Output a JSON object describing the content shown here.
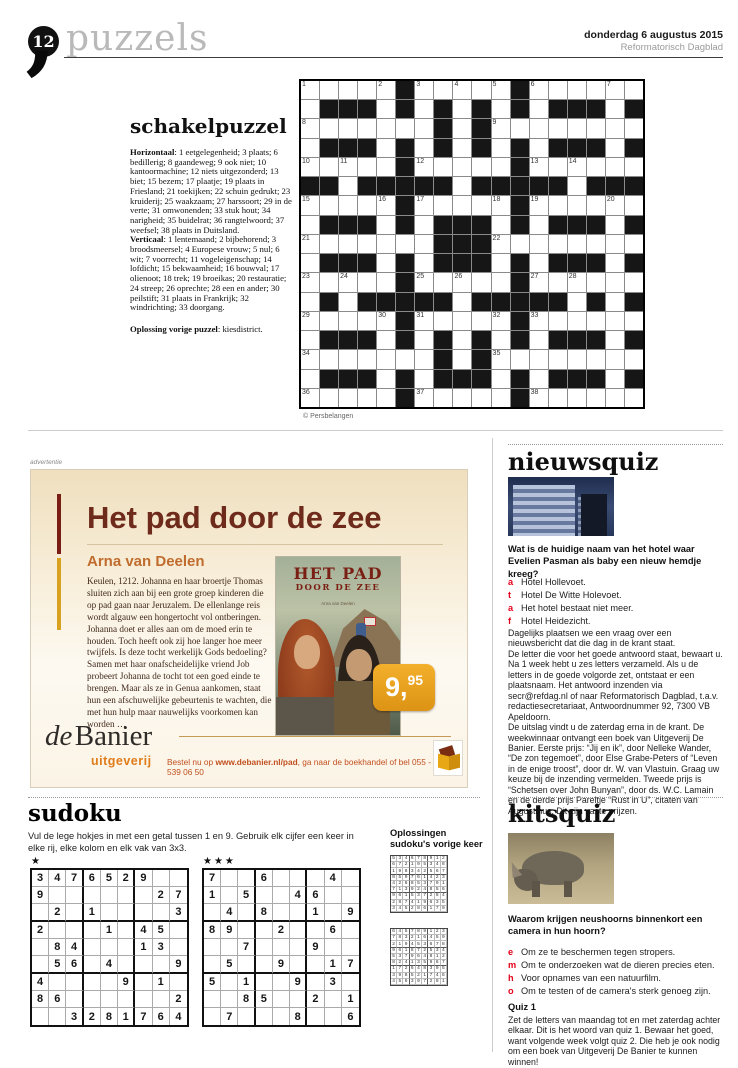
{
  "header": {
    "page_number": "12",
    "section_title": "puzzels",
    "date": "donderdag 6 augustus 2015",
    "publication": "Reformatorisch Dagblad"
  },
  "schakelpuzzel": {
    "title": "schakelpuzzel",
    "horizontaal_label": "Horizontaal",
    "horizontaal": " 1 eetgelegenheid; 3 plaats; 6 bedillerig; 8 gaandeweg; 9 ook niet; 10 kantoormachine; 12 niets uitgezonderd; 13 biet; 15 bezem; 17 plaatje; 19 plaats in Friesland; 21 toekijken; 22 schuin gedrukt; 23 kruiderij; 25 waakzaam; 27 harssoort; 29 in de verte; 31 omwonenden; 33 stuk hout; 34 narigheid; 35 buidelrat; 36 rangtelwoord; 37 weefsel; 38 plaats in Duitsland.",
    "verticaal_label": "Verticaal",
    "verticaal": " 1 lentemaand; 2 bijbehorend; 3 broodsmeersel; 4 Europese vrouw; 5 nul; 6 wit; 7 voorrecht; 11 vogeleigenschap; 14 lofdicht; 15 bekwaamheid; 16 bouwval; 17 olienoot; 18 trek; 19 broeikas; 20 restauratie; 24 streep; 26 oprechte; 28 een en ander; 30 peilstift; 31 plaats in Frankrijk; 32 windrichting; 33 doorgang.",
    "oplossing_label": "Oplossing vorige puzzel",
    "oplossing_text": " kiesdistrict.",
    "credit": "© Persbelangen",
    "grid": {
      "cols": 18,
      "rows": [
        ".....#.....#......",
        ".###.#.#.#.#.###.#",
        ".......#.#........",
        ".###.#.#.#.#.###.#",
        ".....#.....#......",
        "##.#####.#####.###",
        ".....#.....#......",
        ".###.#.###.#.###.#",
        ".......###........",
        ".###.#.###.#.###.#",
        ".....#.....#......",
        ".#.#####.#####.#.#",
        ".....#.....#......",
        ".###.#.#.#.#.###.#",
        ".......#.#........",
        ".###.#.###.#.###.#",
        ".....#.....#......"
      ],
      "numbers": {
        "1-1": "1",
        "1-5": "2",
        "1-7": "3",
        "1-9": "4",
        "1-11": "5",
        "1-13": "6",
        "1-17": "7",
        "3-1": "8",
        "3-11": "9",
        "5-1": "10",
        "5-3": "11",
        "5-7": "12",
        "5-13": "13",
        "5-15": "14",
        "7-1": "15",
        "7-5": "16",
        "7-7": "17",
        "7-11": "18",
        "7-13": "19",
        "7-17": "20",
        "9-1": "21",
        "9-11": "22",
        "11-1": "23",
        "11-3": "24",
        "11-7": "25",
        "11-9": "26",
        "11-13": "27",
        "11-15": "28",
        "13-1": "29",
        "13-5": "30",
        "13-7": "31",
        "13-11": "32",
        "13-13": "33",
        "15-1": "34",
        "15-11": "35",
        "17-1": "36",
        "17-7": "37",
        "17-13": "38"
      }
    }
  },
  "ad": {
    "marker": "advertentie",
    "title": "Het pad door de zee",
    "author": "Arna van Deelen",
    "body": "Keulen, 1212. Johanna en haar broertje Thomas sluiten zich aan bij een grote groep kinderen die op pad gaan naar Jeruzalem. De ellenlange reis wordt algauw een hongertocht vol ontberingen. Johanna doet er alles aan om de moed erin te houden. Toch heeft ook zij hoe langer hoe meer twijfels. Is deze tocht werkelijk Gods bedoeling? Samen met haar onafscheidelijke vriend Job probeert Johanna de tocht tot een goed einde te brengen. Maar als ze in Genua aankomen, staat hun een afschuwelijke gebeurtenis te wachten, die met hun hulp maar nauwelijks voorkomen kan worden …",
    "cover_title": "HET PAD",
    "cover_subtitle": "DOOR DE ZEE",
    "cover_author": "Arna van Deelen",
    "price_main": "9,",
    "price_sup": "95",
    "publisher_de": "de",
    "publisher_name": "Banier",
    "publisher_sub": "uitgeverij",
    "order_prefix": "Bestel nu op ",
    "order_url": "www.debanier.nl/pad",
    "order_suffix": ", ga naar de boekhandel of bel 055 - 539 06 50"
  },
  "nieuwsquiz": {
    "title": "nieuwsquiz",
    "question": "Wat is de huidige naam van het hotel waar Evelien Pasman als baby een nieuw hemdje kreeg?",
    "options": [
      {
        "letter": "a",
        "text": "Hotel Hollevoet."
      },
      {
        "letter": "t",
        "text": "Hotel De Witte Holevoet."
      },
      {
        "letter": "a",
        "text": "Het hotel bestaat niet meer."
      },
      {
        "letter": "f",
        "text": "Hotel Heidezicht."
      }
    ],
    "body1": "Dagelijks plaatsen we een vraag over een nieuwsbericht dat die dag in de krant staat.",
    "body2": "De letter die voor het goede antwoord staat, bewaart u. Na 1 week hebt u zes letters verzameld. Als u de letters in de goede volgorde zet, ontstaat er een plaatsnaam. Het antwoord inzenden via secr@refdag.nl of naar Reformatorisch Dagblad, t.a.v. redactiesecretariaat, Antwoordnummer 92, 7300 VB Apeldoorn.",
    "body3": "De uitslag vindt u de zaterdag erna in de krant. De weekwinnaar ontvangt een boek van Uitgeverij De Banier. Eerste prijs: “Jij en ik”, door Nelleke Wander, “De zon tegemoet”, door Else Grabe-Peters of “Leven in de enige troost”, door dr. W. van Vlastuin. Graag uw keuze bij de inzending vermelden. Tweede prijs is “Schetsen over John Bunyan”, door ds. W.C. Lamain en de derde prijs Pareltje “Rust in U”, citaten van Augustinus. Dit zijn vaste prijzen."
  },
  "sudoku": {
    "title": "sudoku",
    "intro": "Vul de lege hokjes in met een getal tussen 1 en 9. Gebruik elk cijfer een keer in elke rij, elke kolom en elk vak van 3x3.",
    "grid1_stars": "★",
    "grid2_stars": "★★★",
    "grid1": [
      "3476529..",
      "9......27",
      ".2.1....3",
      "2...1.45.",
      ".84...13.",
      ".56.4...9",
      "4....9.1.",
      "86......2",
      "..3281764"
    ],
    "grid2": [
      "7..6...4.",
      "1.5..46..",
      ".4.8..1.9",
      "89..2..6.",
      "..7...9..",
      ".5..9..17",
      "5.1..9.3.",
      "..85..2.1",
      ".7...8..6"
    ],
    "solutions_label_line1": "Oplossingen",
    "solutions_label_line2": "sudoku's vorige keer",
    "solution1": [
      "534678912",
      "672195348",
      "198342567",
      "859761423",
      "426853791",
      "713924856",
      "961537284",
      "287419635",
      "345286179"
    ],
    "solution2": [
      "645789123",
      "783216459",
      "219453678",
      "961872534",
      "537964812",
      "824135967",
      "172648395",
      "398521746",
      "456397281"
    ]
  },
  "kitsquiz": {
    "title": "kitsquiz",
    "question": "Waarom krijgen neushoorns binnenkort een camera in hun hoorn?",
    "options": [
      {
        "letter": "e",
        "text": "Om ze te beschermen tegen stropers."
      },
      {
        "letter": "m",
        "text": "Om te onderzoeken wat de dieren precies eten."
      },
      {
        "letter": "h",
        "text": "Voor opnames van een natuurfilm."
      },
      {
        "letter": "o",
        "text": "Om te testen of de camera's sterk genoeg zijn."
      }
    ],
    "quiz1_label": "Quiz 1",
    "quiz1_text": "Zet de letters van maandag tot en met zaterdag achter elkaar. Dit is het woord van quiz 1. Bewaar het goed, want volgende week volgt quiz 2. Die heb je ook nodig om een boek van Uitgeverij De Banier te kunnen winnen!"
  }
}
